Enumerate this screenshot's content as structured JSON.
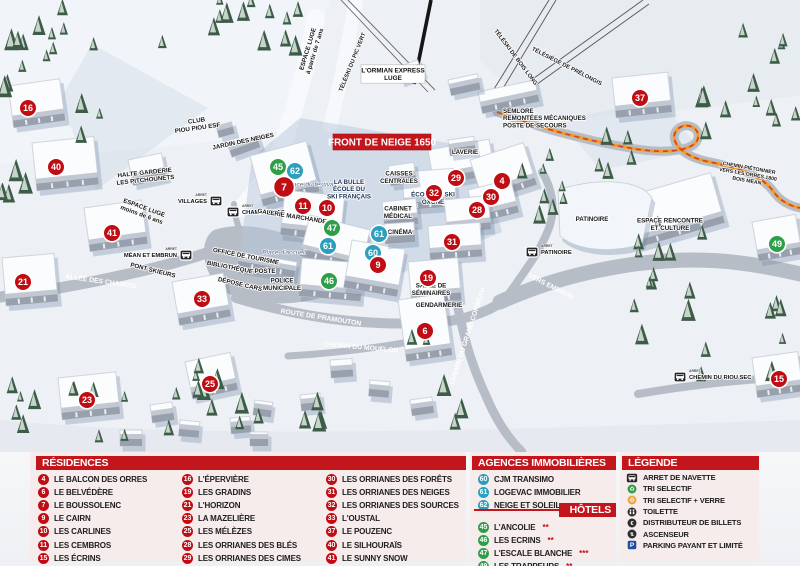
{
  "banner": "FRONT DE NEIGE 1650",
  "colors": {
    "header_red": "#c3161c",
    "marker_red": "#c00c13",
    "marker_blue": "#2aa0bd",
    "marker_green": "#2f9e49",
    "panel_pink": "#f7ecec",
    "parking_blue": "#1c4fa0",
    "path_orange": "#f49b27"
  },
  "legend": {
    "residences": {
      "title": "RÉSIDENCES",
      "columns": [
        [
          {
            "num": "4",
            "label": "LE BALCON DES ORRES"
          },
          {
            "num": "6",
            "label": "LE BELVÉDÈRE"
          },
          {
            "num": "7",
            "label": "LE BOUSSOLENC"
          },
          {
            "num": "9",
            "label": "LE CAIRN"
          },
          {
            "num": "10",
            "label": "LES CARLINES"
          },
          {
            "num": "11",
            "label": "LES CEMBROS"
          },
          {
            "num": "15",
            "label": "LES ÉCRINS"
          }
        ],
        [
          {
            "num": "16",
            "label": "L'ÉPERVIÈRE"
          },
          {
            "num": "19",
            "label": "LES GRADINS"
          },
          {
            "num": "21",
            "label": "L'HORIZON"
          },
          {
            "num": "23",
            "label": "LA MAZELIÈRE"
          },
          {
            "num": "25",
            "label": "LES MÉLÈZES"
          },
          {
            "num": "28",
            "label": "LES ORRIANES DES BLÉS"
          },
          {
            "num": "29",
            "label": "LES ORRIANES DES CIMES"
          }
        ],
        [
          {
            "num": "30",
            "label": "LES ORRIANES DES FORÊTS"
          },
          {
            "num": "31",
            "label": "LES ORRIANES DES NEIGES"
          },
          {
            "num": "32",
            "label": "LES ORRIANES DES SOURCES"
          },
          {
            "num": "33",
            "label": "L'OUSTAL"
          },
          {
            "num": "37",
            "label": "LE POUZENC"
          },
          {
            "num": "40",
            "label": "LE SILHOURAÏS"
          },
          {
            "num": "41",
            "label": "LE SUNNY SNOW"
          }
        ]
      ]
    },
    "agencies": {
      "title": "AGENCES IMMOBILIÈRES",
      "items": [
        {
          "num": "60",
          "label": "CJM TRANSIMO"
        },
        {
          "num": "61",
          "label": "LOGEVAC IMMOBILIER"
        },
        {
          "num": "62",
          "label": "NEIGE ET SOLEIL"
        }
      ]
    },
    "hotels": {
      "title": "HÔTELS",
      "items": [
        {
          "num": "45",
          "label": "L'ANCOLIE",
          "stars": "**"
        },
        {
          "num": "46",
          "label": "LES ECRINS",
          "stars": "**"
        },
        {
          "num": "47",
          "label": "L'ESCALE BLANCHE",
          "stars": "***"
        },
        {
          "num": "49",
          "label": "LES TRAPPEURS",
          "stars": "**"
        }
      ]
    },
    "legende": {
      "title": "LÉGENDE",
      "items": [
        {
          "icon": "bus",
          "label": "ARRET DE NAVETTE"
        },
        {
          "icon": "recycle-green",
          "label": "TRI SELECTIF"
        },
        {
          "icon": "recycle-yellow",
          "label": "TRI SELECTIF + VERRE"
        },
        {
          "icon": "wc",
          "label": "TOILETTE"
        },
        {
          "icon": "euro",
          "label": "DISTRIBUTEUR DE BILLETS"
        },
        {
          "icon": "elevator",
          "label": "ASCENSEUR"
        },
        {
          "icon": "parking",
          "label": "PARKING PAYANT ET LIMITÉ"
        }
      ]
    }
  },
  "map": {
    "markers": [
      {
        "n": "16",
        "type": "residence",
        "x": 28,
        "y": 108
      },
      {
        "n": "40",
        "type": "residence",
        "x": 56,
        "y": 167
      },
      {
        "n": "41",
        "type": "residence",
        "x": 112,
        "y": 233
      },
      {
        "n": "21",
        "type": "residence",
        "x": 23,
        "y": 282
      },
      {
        "n": "33",
        "type": "residence",
        "x": 202,
        "y": 299
      },
      {
        "n": "23",
        "type": "residence",
        "x": 87,
        "y": 400
      },
      {
        "n": "25",
        "type": "residence",
        "x": 210,
        "y": 384
      },
      {
        "n": "45",
        "type": "hotel",
        "x": 278,
        "y": 167
      },
      {
        "n": "62",
        "type": "agency",
        "x": 295,
        "y": 171
      },
      {
        "n": "7",
        "type": "residence",
        "x": 284,
        "y": 187,
        "big": true
      },
      {
        "n": "11",
        "type": "residence",
        "x": 303,
        "y": 206
      },
      {
        "n": "10",
        "type": "residence",
        "x": 327,
        "y": 208
      },
      {
        "n": "47",
        "type": "hotel",
        "x": 332,
        "y": 228
      },
      {
        "n": "61",
        "type": "agency",
        "x": 379,
        "y": 234
      },
      {
        "n": "61",
        "type": "agency",
        "x": 328,
        "y": 246
      },
      {
        "n": "60",
        "type": "agency",
        "x": 373,
        "y": 253
      },
      {
        "n": "9",
        "type": "residence",
        "x": 378,
        "y": 265
      },
      {
        "n": "46",
        "type": "hotel",
        "x": 329,
        "y": 281
      },
      {
        "n": "29",
        "type": "residence",
        "x": 456,
        "y": 178
      },
      {
        "n": "32",
        "type": "residence",
        "x": 434,
        "y": 193
      },
      {
        "n": "4",
        "type": "residence",
        "x": 502,
        "y": 181
      },
      {
        "n": "30",
        "type": "residence",
        "x": 491,
        "y": 197
      },
      {
        "n": "28",
        "type": "residence",
        "x": 477,
        "y": 210
      },
      {
        "n": "31",
        "type": "residence",
        "x": 452,
        "y": 242
      },
      {
        "n": "19",
        "type": "residence",
        "x": 428,
        "y": 278
      },
      {
        "n": "6",
        "type": "residence",
        "x": 425,
        "y": 331
      },
      {
        "n": "37",
        "type": "residence",
        "x": 640,
        "y": 98
      },
      {
        "n": "49",
        "type": "hotel",
        "x": 777,
        "y": 244
      },
      {
        "n": "15",
        "type": "residence",
        "x": 779,
        "y": 379
      }
    ],
    "stops": [
      {
        "label": "VILLAGES",
        "x": 216,
        "y": 201,
        "dir": "left"
      },
      {
        "label": "CHAMP LACAS",
        "x": 233,
        "y": 212,
        "dir": "right"
      },
      {
        "label": "MÉAN ET EMBRUN",
        "x": 186,
        "y": 255,
        "dir": "left"
      },
      {
        "label": "PATINOIRE",
        "x": 532,
        "y": 252,
        "dir": "right"
      },
      {
        "label": "CHEMIN DU RIOU SEC",
        "x": 680,
        "y": 377,
        "dir": "right"
      }
    ],
    "amenities": [
      {
        "type": "recycle-green",
        "x": 193,
        "y": 231
      },
      {
        "type": "recycle-green",
        "x": 49,
        "y": 279
      },
      {
        "type": "recycle-green",
        "x": 358,
        "y": 327
      },
      {
        "type": "recycle-green",
        "x": 719,
        "y": 155
      },
      {
        "type": "recycle-yellow",
        "x": 250,
        "y": 236
      },
      {
        "type": "parking",
        "x": 264,
        "y": 236
      },
      {
        "type": "euro",
        "x": 275,
        "y": 222
      },
      {
        "type": "elevator",
        "x": 305,
        "y": 233
      },
      {
        "type": "wc",
        "x": 316,
        "y": 235
      }
    ],
    "labels": [
      {
        "lines": [
          "CLUB",
          "PIOU PIOU ESF"
        ],
        "x": 197,
        "y": 124,
        "cls": "place",
        "rot": -8
      },
      {
        "lines": [
          "JARDIN DES NEIGES"
        ],
        "x": 243,
        "y": 141,
        "cls": "place",
        "rot": -12
      },
      {
        "lines": [
          "HALTE GARDERIE",
          "LES PITCHOUNETS"
        ],
        "x": 145,
        "y": 176,
        "cls": "place",
        "rot": -6
      },
      {
        "lines": [
          "ESPACE LUGE",
          "moins de 6 ans"
        ],
        "x": 143,
        "y": 211,
        "cls": "place",
        "rot": 20
      },
      {
        "lines": [
          "ESPACE LUGE",
          "à partir de 7 ans"
        ],
        "x": 311,
        "y": 50,
        "cls": "place",
        "rot": -73
      },
      {
        "lines": [
          "TÉLÉSKI DU PIC VERT"
        ],
        "x": 352,
        "y": 62,
        "cls": "lift",
        "rot": -68
      },
      {
        "lines": [
          "TÉLÉSKI DE BOIS LONG"
        ],
        "x": 516,
        "y": 57,
        "cls": "lift",
        "rot": 53
      },
      {
        "lines": [
          "TÉLÉSIÈGE DE PRÉLONGIS"
        ],
        "x": 567,
        "y": 66,
        "cls": "lift",
        "rot": 27
      },
      {
        "lines": [
          "L'ORMIAN EXPRESS",
          "LUGE"
        ],
        "x": 393,
        "y": 74,
        "cls": "boxed"
      },
      {
        "lines": [
          "SEMLORE",
          "REMONTÉES MÉCANIQUES",
          "POSTE DE SECOURS"
        ],
        "x": 503,
        "y": 118,
        "cls": "place",
        "anchor": "start"
      },
      {
        "lines": [
          "LAVERIE"
        ],
        "x": 465,
        "y": 152,
        "cls": "place"
      },
      {
        "lines": [
          "CAISSES",
          "CENTRALES"
        ],
        "x": 399,
        "y": 177,
        "cls": "place"
      },
      {
        "lines": [
          "Place du festival"
        ],
        "x": 311,
        "y": 184,
        "cls": "italic"
      },
      {
        "lines": [
          "LA BULLE",
          "ÉCOLE DU",
          "SKI FRANÇAIS"
        ],
        "x": 349,
        "y": 189,
        "cls": "navy"
      },
      {
        "lines": [
          "ÉCOLE DE SKI",
          "OXONE"
        ],
        "x": 433,
        "y": 198,
        "cls": "navy"
      },
      {
        "lines": [
          "GALERIE MARCHANDE"
        ],
        "x": 292,
        "y": 216,
        "cls": "place",
        "rot": 9
      },
      {
        "lines": [
          "CABINET",
          "MÉDICAL"
        ],
        "x": 398,
        "y": 212,
        "cls": "place"
      },
      {
        "lines": [
          "CINÉMA"
        ],
        "x": 400,
        "y": 232,
        "cls": "place"
      },
      {
        "lines": [
          "Place d'accueil"
        ],
        "x": 284,
        "y": 252,
        "cls": "italic"
      },
      {
        "lines": [
          "OFFICE DE TOURISME"
        ],
        "x": 246,
        "y": 256,
        "cls": "place",
        "rot": 11
      },
      {
        "lines": [
          "BIBLIOTHÈQUE"
        ],
        "x": 230,
        "y": 267,
        "cls": "place",
        "rot": 11
      },
      {
        "lines": [
          "POSTE"
        ],
        "x": 265,
        "y": 271,
        "cls": "place"
      },
      {
        "lines": [
          "DÉPOSE CARS"
        ],
        "x": 240,
        "y": 284,
        "cls": "place",
        "rot": 13
      },
      {
        "lines": [
          "POLICE",
          "MUNICIPALE"
        ],
        "x": 282,
        "y": 284,
        "cls": "place"
      },
      {
        "lines": [
          "SALLE DE",
          "SÉMINAIRES"
        ],
        "x": 431,
        "y": 289,
        "cls": "place"
      },
      {
        "lines": [
          "GENDARMERIE"
        ],
        "x": 439,
        "y": 305,
        "cls": "place"
      },
      {
        "lines": [
          "PATINOIRE"
        ],
        "x": 592,
        "y": 219,
        "cls": "place"
      },
      {
        "lines": [
          "ESPACE RENCONTRE",
          "ET CULTURE"
        ],
        "x": 670,
        "y": 224,
        "cls": "place"
      },
      {
        "lines": [
          "CHEMIN PIÉTONNIER",
          "VERS LES ORRES 1800",
          "BOIS MÉAN"
        ],
        "x": 748,
        "y": 174,
        "cls": "tiny",
        "rot": 10
      },
      {
        "lines": [
          "ALLÉE DES CHAMOIS"
        ],
        "x": 101,
        "y": 281,
        "cls": "road",
        "rot": 8
      },
      {
        "lines": [
          "PONT SKIEURS"
        ],
        "x": 153,
        "y": 270,
        "cls": "place",
        "rot": 14
      },
      {
        "lines": [
          "ROUTE DE PRAMOUTON"
        ],
        "x": 321,
        "y": 317,
        "cls": "road",
        "rot": 9
      },
      {
        "lines": [
          "CHEMIN DU MOUFLON"
        ],
        "x": 361,
        "y": 347,
        "cls": "road",
        "rot": 5
      },
      {
        "lines": [
          "CHEMIN DU GRAND CORBEAU"
        ],
        "x": 467,
        "y": 336,
        "cls": "road",
        "rot": -72
      },
      {
        "lines": [
          "VERS EMBRUN"
        ],
        "x": 551,
        "y": 286,
        "cls": "road",
        "rot": 27
      }
    ]
  }
}
